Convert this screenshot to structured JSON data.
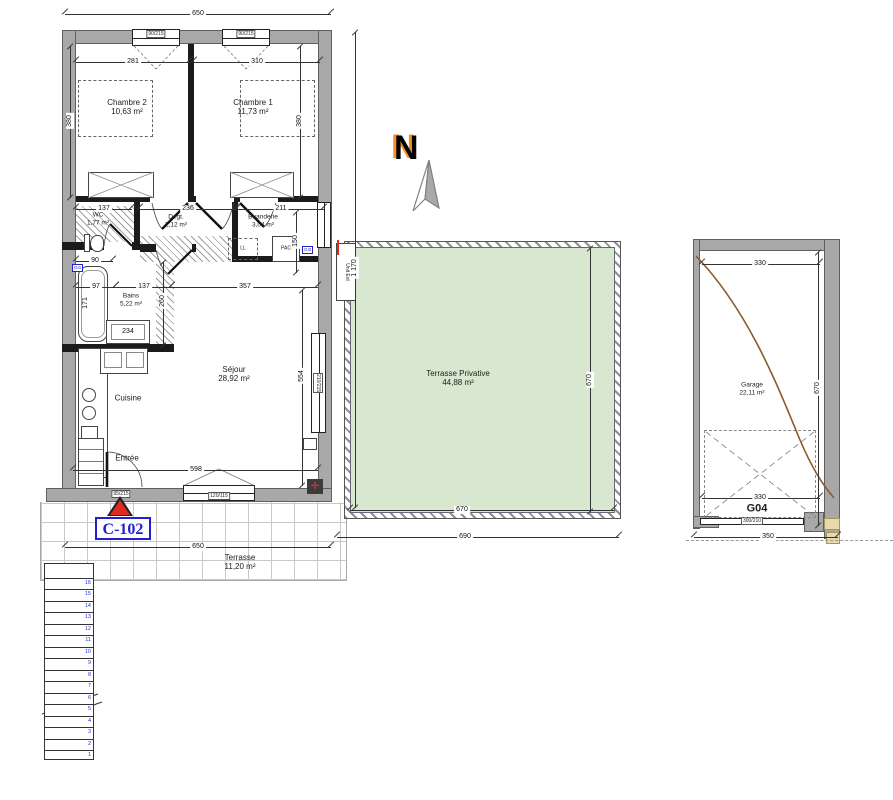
{
  "meta": {
    "unit_label": "C-102",
    "garage_code": "G04",
    "compass_n": "N"
  },
  "rooms": {
    "chambre2": {
      "name": "Chambre 2",
      "area": "10,63 m²"
    },
    "chambre1": {
      "name": "Chambre 1",
      "area": "11,73 m²"
    },
    "wc": {
      "name": "WC",
      "area": "1,77 m²"
    },
    "degagement": {
      "name": "Degt.",
      "area": "2,12 m²"
    },
    "buanderie": {
      "name": "Buanderie",
      "area": "3,04 m²"
    },
    "bains": {
      "name": "Bains",
      "area": "5,22 m²"
    },
    "sejour": {
      "name": "Séjour",
      "area": "28,92 m²"
    },
    "cuisine": {
      "name": "Cuisine"
    },
    "entree": {
      "name": "Entrée"
    },
    "terrasse_privative": {
      "name": "Terrasse Privative",
      "area": "44,88 m²"
    },
    "terrasse": {
      "name": "Terrasse",
      "area": "11,20 m²"
    },
    "garage": {
      "name": "Garage",
      "area": "22,11 m²"
    }
  },
  "equipment": {
    "lave_linge": "LL",
    "pac": "PAC",
    "unit_ext": "Unit Ext",
    "gi1": "GI1",
    "gi2": "GI2"
  },
  "openings": {
    "window_chambre2": "90/215",
    "window_chambre1": "90/215",
    "entry_door": "95/215",
    "window_sejour_south": "120/115",
    "bay_sejour_east": "210/215",
    "garage_door": "300/210"
  },
  "dimensions": {
    "top_width": "650",
    "chambre2_width": "281",
    "chambre1_width": "310",
    "chambre2_height": "380",
    "chambre1_height": "380",
    "wc_width": "137",
    "degt_width": "236",
    "buanderie_width": "211",
    "buanderie_height": "150",
    "wc_depth": "90",
    "bains_offset": "97",
    "bains_width": "137",
    "sejour_top_width": "357",
    "tub_length": "171",
    "bains_height": "260",
    "vanity_width": "234",
    "sejour_height": "554",
    "sejour_width": "598",
    "bottom_width": "650",
    "total_height": "1 170",
    "terrasse_height": "670",
    "terrasse_width": "670",
    "terrasse_outer_width": "690",
    "garage_width_top": "330",
    "garage_height": "670",
    "garage_width_bottom": "330",
    "garage_outer_width": "350"
  },
  "stairs": {
    "steps": [
      "1",
      "2",
      "3",
      "4",
      "5",
      "6",
      "7",
      "8",
      "9",
      "10",
      "11",
      "12",
      "13",
      "14",
      "15",
      "16"
    ]
  },
  "colors": {
    "terrace_green": "#d8e8d0",
    "accent_blue": "#2020d0",
    "accent_red": "#e02a1e",
    "wall_gray": "#a8a8a8",
    "curve_brown": "#8a5a28"
  }
}
